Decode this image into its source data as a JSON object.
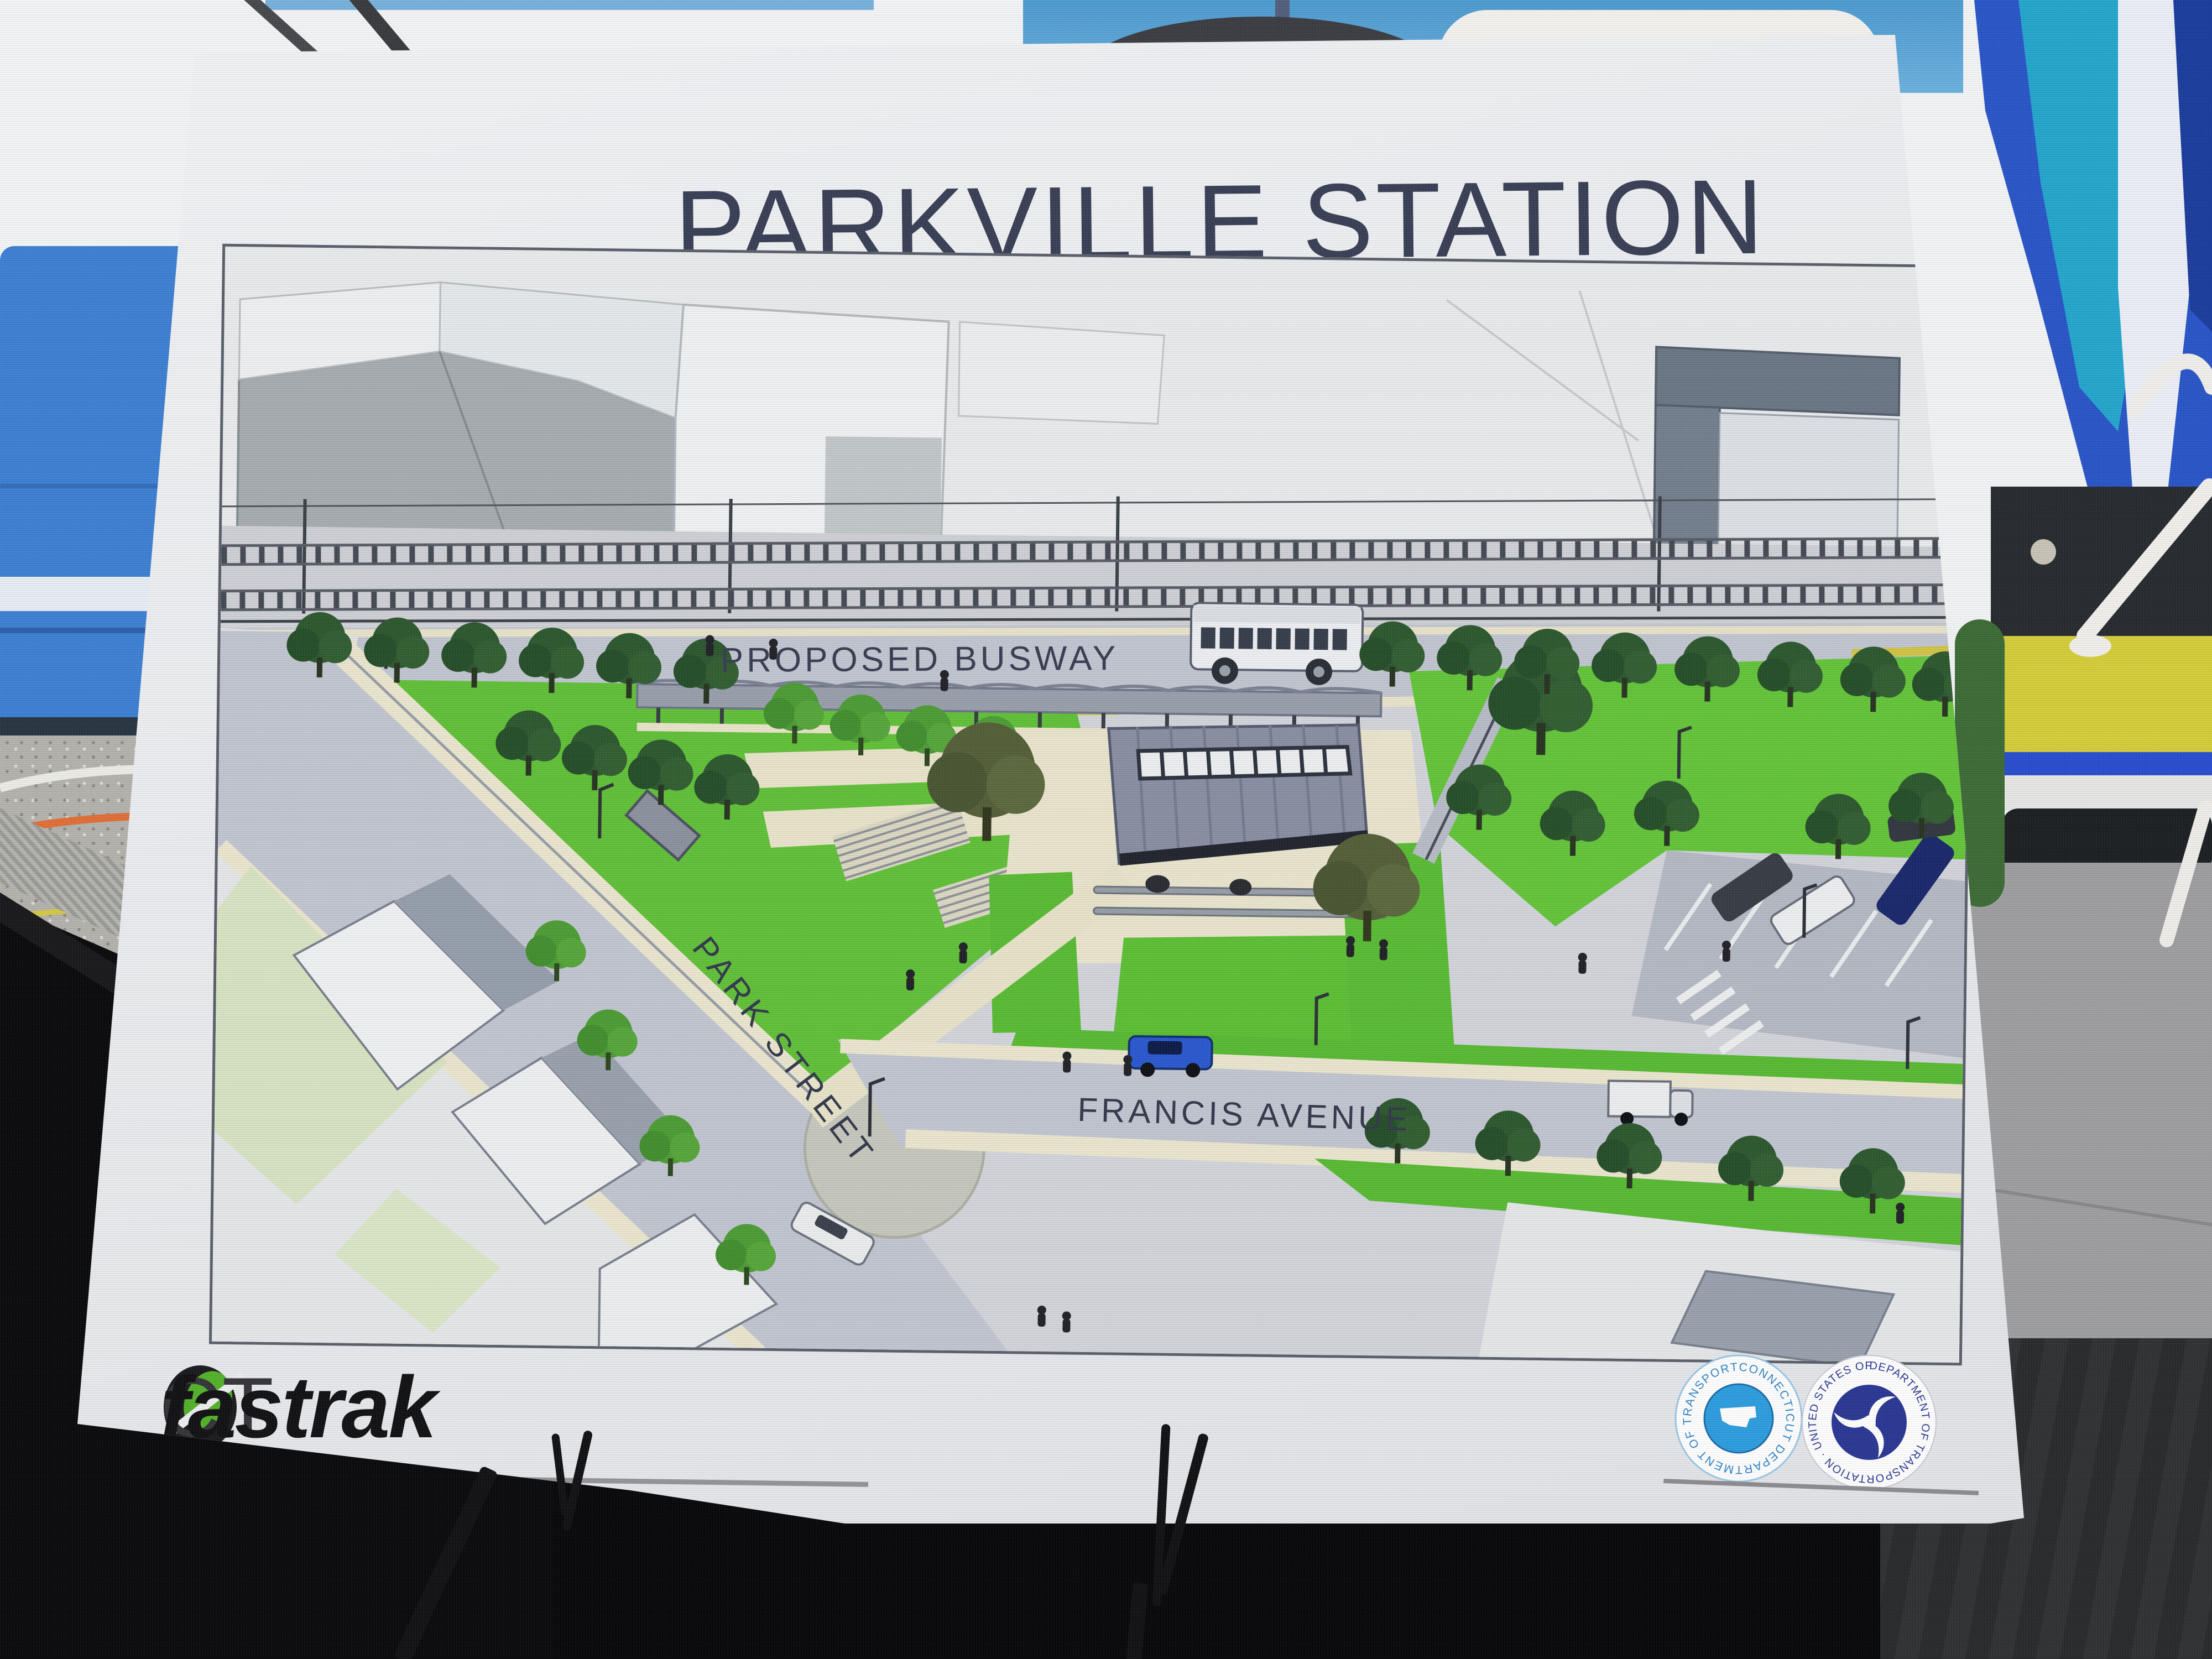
{
  "poster": {
    "title": "PARKVILLE STATION",
    "plan": {
      "label_busway": "PROPOSED BUSWAY",
      "label_park_street": "PARK STREET",
      "label_francis_avenue": "FRANCIS AVENUE"
    },
    "footer": {
      "brand_ct": "CT",
      "brand_fastrak": "fastrak",
      "ctdot_ring_text": "CONNECTICUT  DEPARTMENT  OF  TRANSPORTATION",
      "usdot_ring_text": "DEPARTMENT OF TRANSPORTATION · UNITED STATES OF AMERICA"
    }
  },
  "colors": {
    "brand_green": "#56b32d",
    "brand_dark": "#1d1d20",
    "ctdot_blue": "#2f9fe0",
    "usdot_navy": "#2d3a96",
    "lawn_green": "#63c23b",
    "lawn_green_bright": "#5bbd36",
    "plan_road": "#c3c7d2",
    "walkway_cream": "#ebe6cf",
    "canopy_slate": "#8b91a4",
    "title_ink": "#3b4157",
    "bus_blue": "#3f82d4",
    "flag_blue": "#2b57c9"
  }
}
